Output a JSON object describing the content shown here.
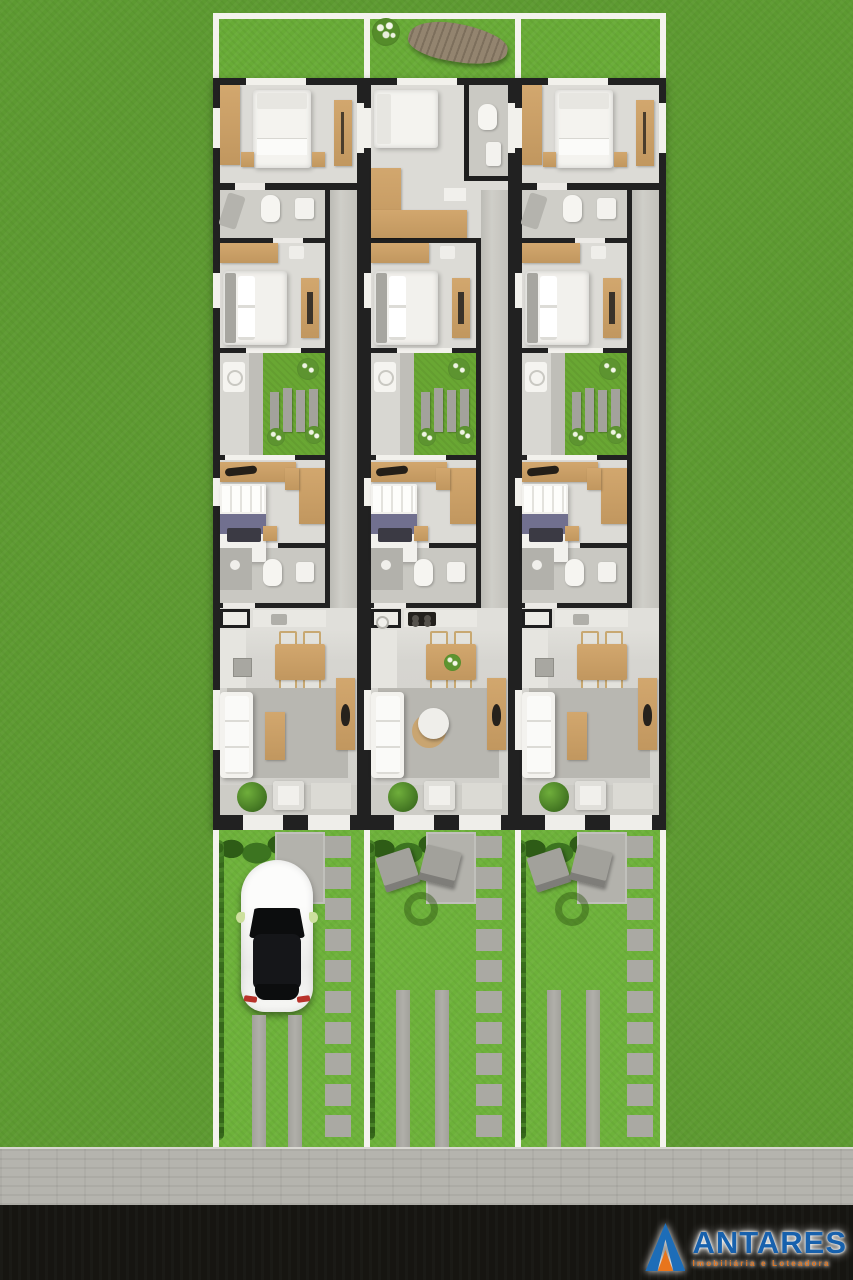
{
  "branding": {
    "name": "ANTARES",
    "tagline": "Imobiliária e Loteadora",
    "brand_blue": "#1b67b0",
    "brand_orange": "#e8751c",
    "logo_icon": "triangle-a-icon"
  },
  "site": {
    "type": "residential-site-plan-render",
    "view": "top-down",
    "units": [
      {
        "id": "unit-1",
        "variant": "A",
        "rooms": [
          "bedroom 1",
          "bathroom 1",
          "bedroom 2",
          "patio garden",
          "bedroom 3",
          "bathroom 2",
          "kitchen / dining / living",
          "front porch"
        ],
        "front_yard": [
          "hedge",
          "entry path",
          "stepping stones",
          "parked white car",
          "driveway tracks"
        ]
      },
      {
        "id": "unit-2",
        "variant": "B",
        "rooms": [
          "bedroom 1",
          "ensuite bathroom",
          "hallway",
          "bedroom 2",
          "patio garden",
          "bedroom 3",
          "bathroom 2",
          "kitchen / dining / living",
          "front porch"
        ],
        "front_yard": [
          "hedge",
          "entry path",
          "stepping stones",
          "two lounge chairs",
          "garden ring",
          "driveway tracks"
        ]
      },
      {
        "id": "unit-3",
        "variant": "A",
        "rooms": [
          "bedroom 1",
          "bathroom 1",
          "bedroom 2",
          "patio garden",
          "bedroom 3",
          "bathroom 2",
          "kitchen / dining / living",
          "front porch"
        ],
        "front_yard": [
          "hedge",
          "entry path",
          "stepping stones",
          "two lounge chairs",
          "garden ring",
          "driveway tracks"
        ]
      }
    ],
    "backyard_items": [
      "flowering shrub",
      "wooden surfboard deck table"
    ],
    "street_elements": [
      "paved sidewalk",
      "asphalt road"
    ]
  },
  "colors": {
    "grass": "#5d9a31",
    "lawn": "#6db23a",
    "backyard": "#68ab36",
    "wall": "#1f1f1f",
    "floor": "#dcdbd6",
    "wood": "#cda269",
    "courtyard_green": "#69a733",
    "fence_white": "#f4f3ee",
    "sidewalk": "#b5b4ae",
    "road": "#161511"
  }
}
